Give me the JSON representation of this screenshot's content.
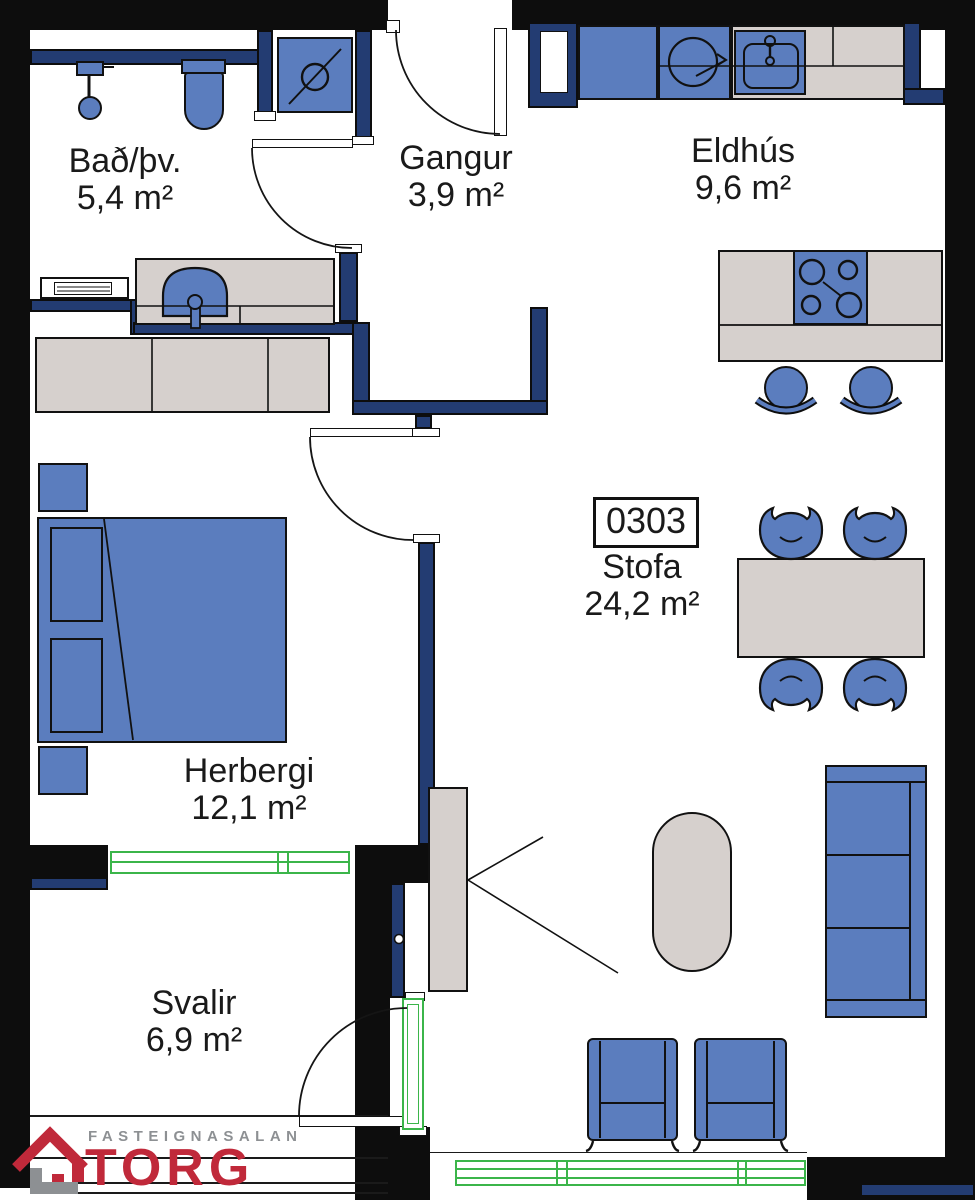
{
  "plan": {
    "unit_number": "0303",
    "rooms": {
      "bathroom": {
        "name": "Bað/þv.",
        "area": "5,4 m²"
      },
      "hallway": {
        "name": "Gangur",
        "area": "3,9 m²"
      },
      "kitchen": {
        "name": "Eldhús",
        "area": "9,6 m²"
      },
      "bedroom": {
        "name": "Herbergi",
        "area": "12,1 m²"
      },
      "living_room": {
        "name": "Stofa",
        "area": "24,2 m²"
      },
      "balcony": {
        "name": "Svalir",
        "area": "6,9 m²"
      }
    }
  },
  "logo": {
    "top_text": "FASTEIGNASALAN",
    "brand": "TORG"
  },
  "colors": {
    "wall_black": "#0d0d0d",
    "wall_navy": "#233c72",
    "furniture_blue": "#5b7dbe",
    "furniture_gray": "#d6d0cd",
    "window_green": "#3bb54a",
    "logo_red": "#c0293a",
    "logo_gray": "#8d9093"
  },
  "icons": [
    "entrance-door",
    "shower",
    "toilet",
    "floor-drain",
    "washbasin",
    "radiator",
    "shaft-niche",
    "fridge",
    "appliance-circle",
    "kitchen-sink",
    "cooktop",
    "kitchen-island",
    "bar-stool",
    "wardrobe",
    "double-bed",
    "nightstand",
    "dining-table",
    "dining-chair",
    "sofa",
    "coffee-table",
    "armchair",
    "balcony-door",
    "window",
    "railing"
  ]
}
